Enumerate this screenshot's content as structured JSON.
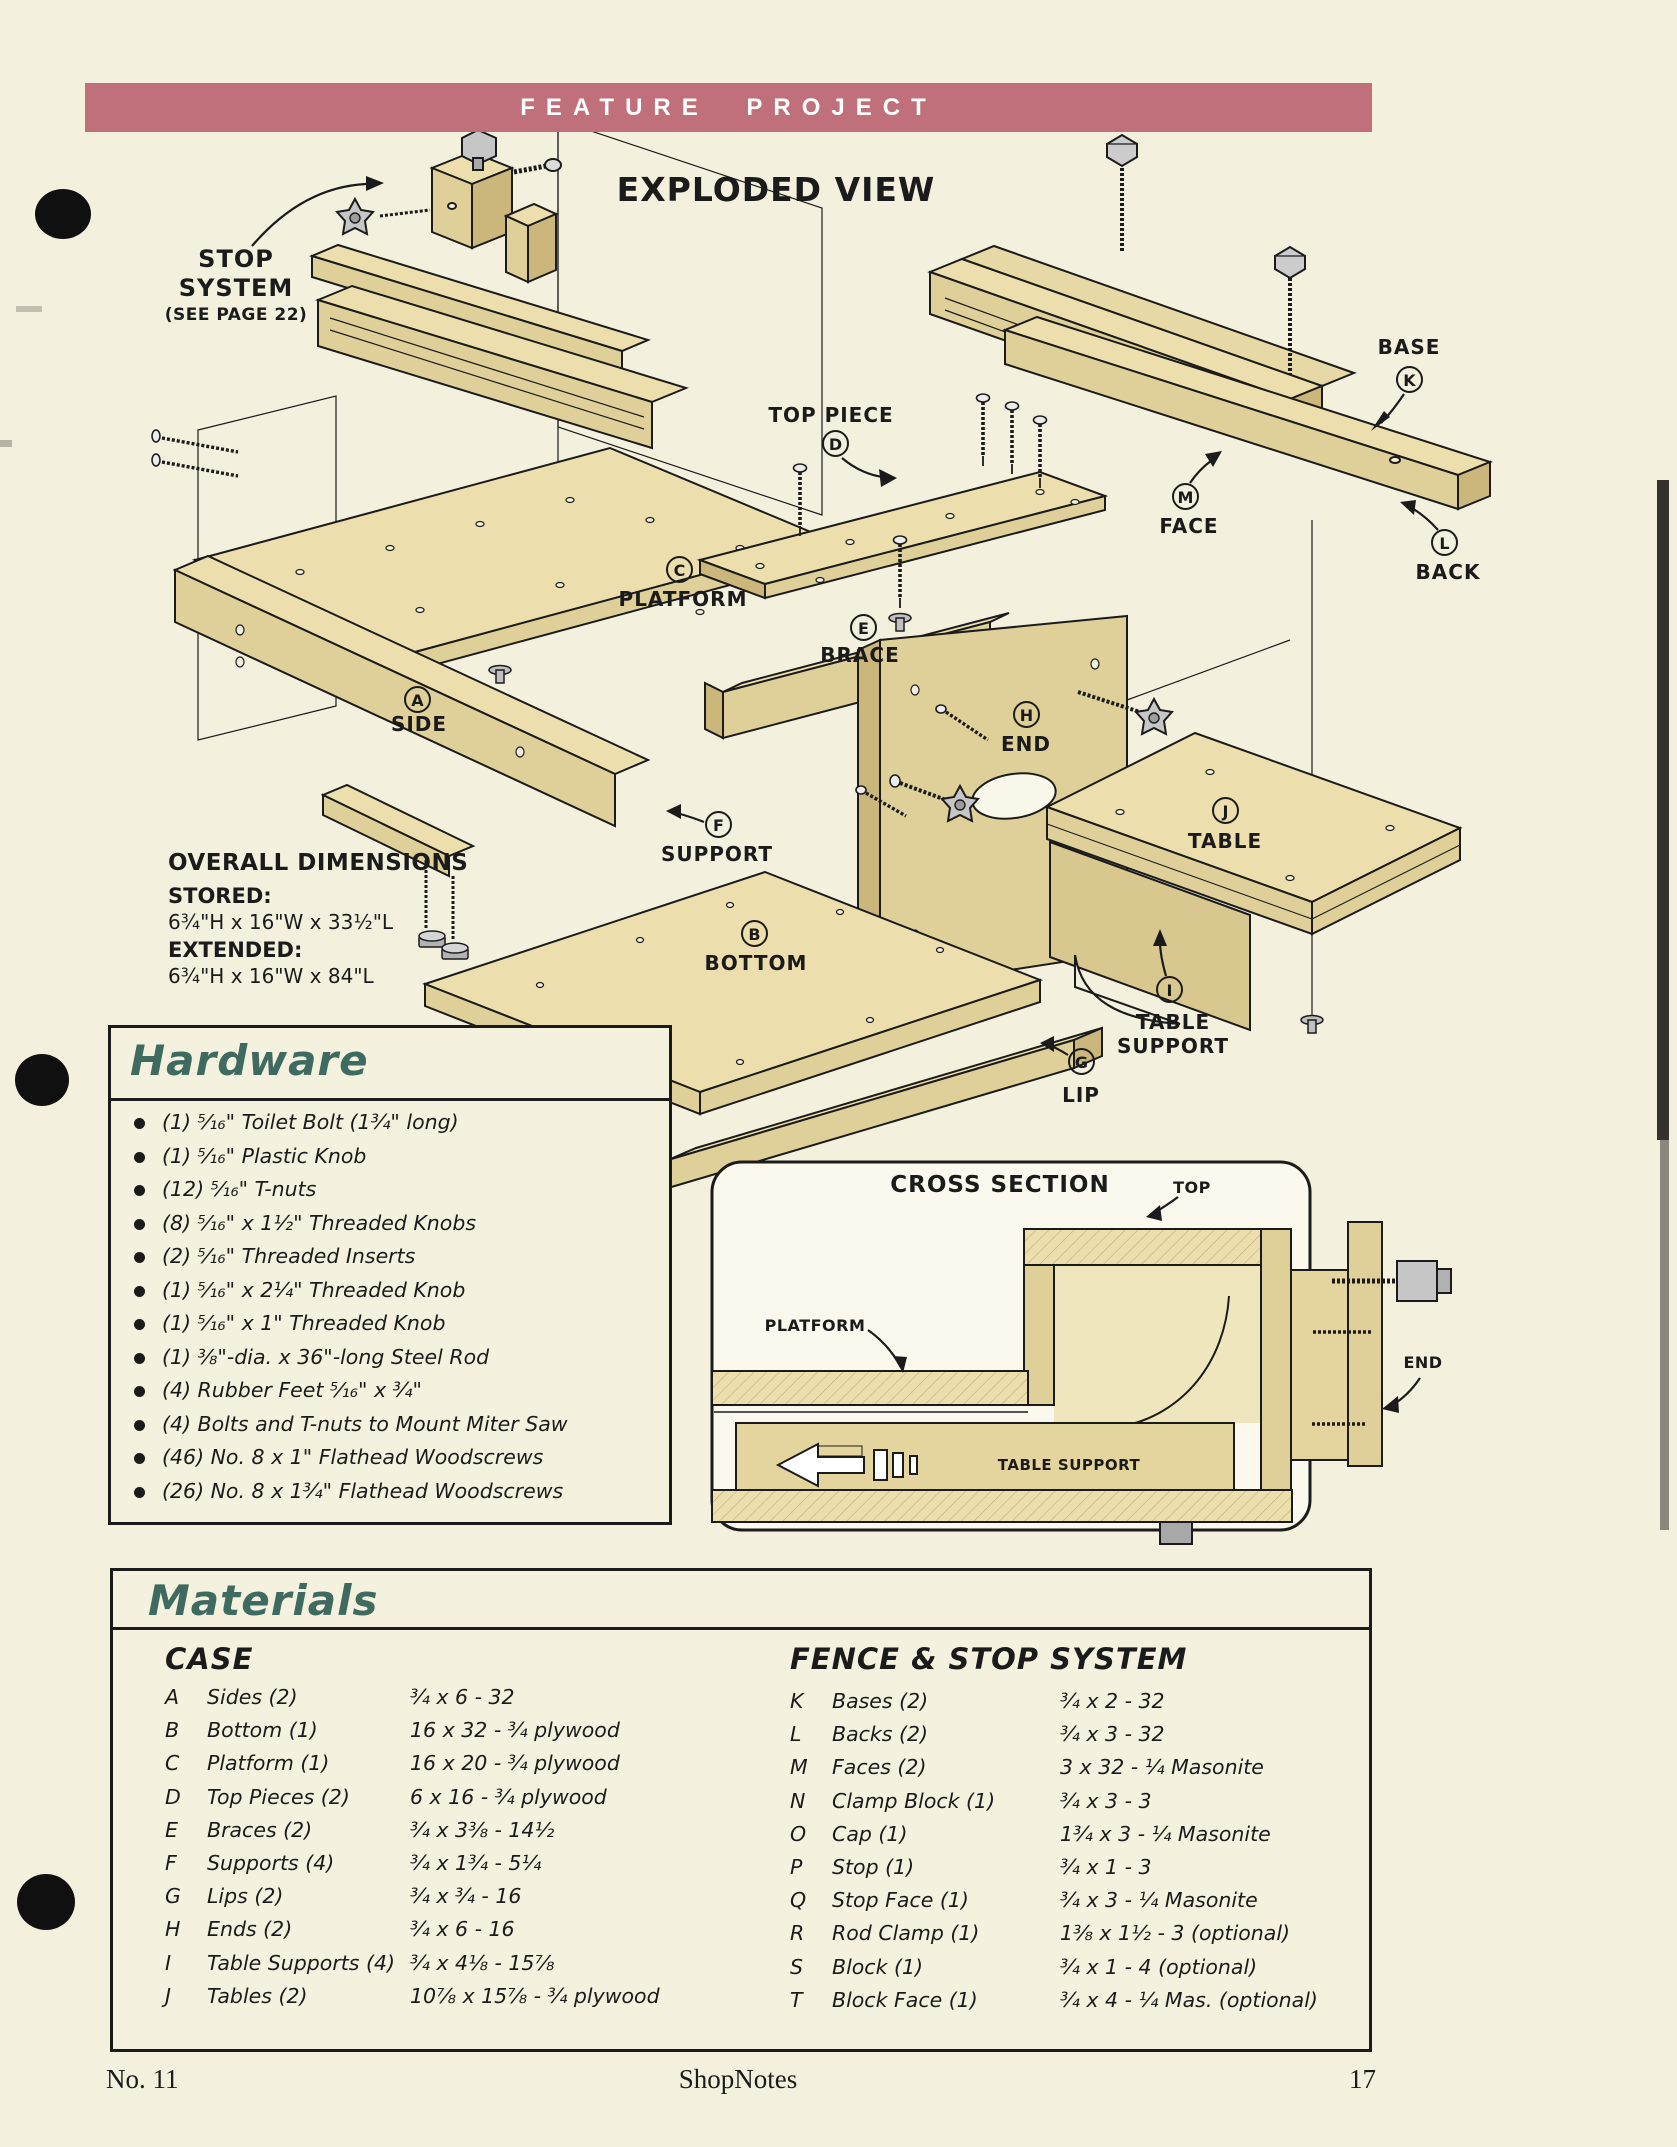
{
  "banner": {
    "label": "FEATURE PROJECT"
  },
  "exploded": {
    "title": "EXPLODED VIEW",
    "stop_system": {
      "label": "STOP SYSTEM",
      "note": "(SEE PAGE 22)"
    },
    "dimensions": {
      "heading": "OVERALL DIMENSIONS",
      "stored_label": "STORED:",
      "stored_value": "6¾\"H x 16\"W x 33½\"L",
      "extended_label": "EXTENDED:",
      "extended_value": "6¾\"H x 16\"W x 84\"L"
    },
    "parts": [
      {
        "letter": "A",
        "label": "SIDE"
      },
      {
        "letter": "B",
        "label": "BOTTOM"
      },
      {
        "letter": "C",
        "label": "PLATFORM"
      },
      {
        "letter": "D",
        "label": "TOP PIECE"
      },
      {
        "letter": "E",
        "label": "BRACE"
      },
      {
        "letter": "F",
        "label": "SUPPORT"
      },
      {
        "letter": "G",
        "label": "LIP"
      },
      {
        "letter": "H",
        "label": "END"
      },
      {
        "letter": "I",
        "label": "TABLE SUPPORT"
      },
      {
        "letter": "J",
        "label": "TABLE"
      },
      {
        "letter": "K",
        "label": "BASE"
      },
      {
        "letter": "L",
        "label": "BACK"
      },
      {
        "letter": "M",
        "label": "FACE"
      }
    ]
  },
  "hardware": {
    "title": "Hardware",
    "items": [
      "(1) ⁵⁄₁₆\" Toilet Bolt (1¾\" long)",
      "(1) ⁵⁄₁₆\" Plastic Knob",
      "(12) ⁵⁄₁₆\" T-nuts",
      "(8) ⁵⁄₁₆\" x 1½\" Threaded Knobs",
      "(2) ⁵⁄₁₆\" Threaded Inserts",
      "(1) ⁵⁄₁₆\" x 2¼\" Threaded Knob",
      "(1) ⁵⁄₁₆\" x 1\" Threaded Knob",
      "(1) ⅜\"-dia. x 36\"-long Steel Rod",
      "(4) Rubber Feet ⁵⁄₁₆\" x ¾\"",
      "(4) Bolts and T-nuts to Mount Miter Saw",
      "(46) No. 8 x 1\" Flathead Woodscrews",
      "(26) No. 8 x 1¾\" Flathead Woodscrews"
    ]
  },
  "cross_section": {
    "title": "CROSS SECTION",
    "labels": {
      "top": "TOP",
      "platform": "PLATFORM",
      "table_support": "TABLE SUPPORT",
      "end": "END"
    }
  },
  "materials": {
    "title": "Materials",
    "case": {
      "heading": "CASE",
      "rows": [
        {
          "letter": "A",
          "name": "Sides (2)",
          "size": "¾ x 6 - 32"
        },
        {
          "letter": "B",
          "name": "Bottom (1)",
          "size": "16 x 32 - ¾ plywood"
        },
        {
          "letter": "C",
          "name": "Platform (1)",
          "size": "16 x 20 - ¾ plywood"
        },
        {
          "letter": "D",
          "name": "Top Pieces (2)",
          "size": "6 x 16 - ¾ plywood"
        },
        {
          "letter": "E",
          "name": "Braces (2)",
          "size": "¾ x 3⅜ - 14½"
        },
        {
          "letter": "F",
          "name": "Supports (4)",
          "size": "¾ x 1¾ - 5¼"
        },
        {
          "letter": "G",
          "name": "Lips (2)",
          "size": "¾ x ¾ - 16"
        },
        {
          "letter": "H",
          "name": "Ends (2)",
          "size": "¾ x 6 - 16"
        },
        {
          "letter": "I",
          "name": "Table Supports (4)",
          "size": "¾ x 4⅛ - 15⅞"
        },
        {
          "letter": "J",
          "name": "Tables (2)",
          "size": "10⅞ x 15⅞ - ¾ plywood"
        }
      ]
    },
    "fence": {
      "heading": "FENCE & STOP SYSTEM",
      "rows": [
        {
          "letter": "K",
          "name": "Bases (2)",
          "size": "¾ x 2 - 32"
        },
        {
          "letter": "L",
          "name": "Backs (2)",
          "size": "¾ x 3 - 32"
        },
        {
          "letter": "M",
          "name": "Faces (2)",
          "size": "3 x 32 - ¼ Masonite"
        },
        {
          "letter": "N",
          "name": "Clamp Block (1)",
          "size": "¾ x 3 - 3"
        },
        {
          "letter": "O",
          "name": "Cap (1)",
          "size": "1¾ x 3 - ¼ Masonite"
        },
        {
          "letter": "P",
          "name": "Stop (1)",
          "size": "¾ x 1 - 3"
        },
        {
          "letter": "Q",
          "name": "Stop Face (1)",
          "size": "¾ x 3 - ¼ Masonite"
        },
        {
          "letter": "R",
          "name": "Rod Clamp (1)",
          "size": "1⅜ x 1½ - 3 (optional)"
        },
        {
          "letter": "S",
          "name": "Block (1)",
          "size": "¾ x 1 - 4 (optional)"
        },
        {
          "letter": "T",
          "name": "Block Face (1)",
          "size": "¾ x 4 - ¼ Mas. (optional)"
        }
      ]
    }
  },
  "footer": {
    "issue": "No. 11",
    "magazine": "ShopNotes",
    "page": "17"
  }
}
